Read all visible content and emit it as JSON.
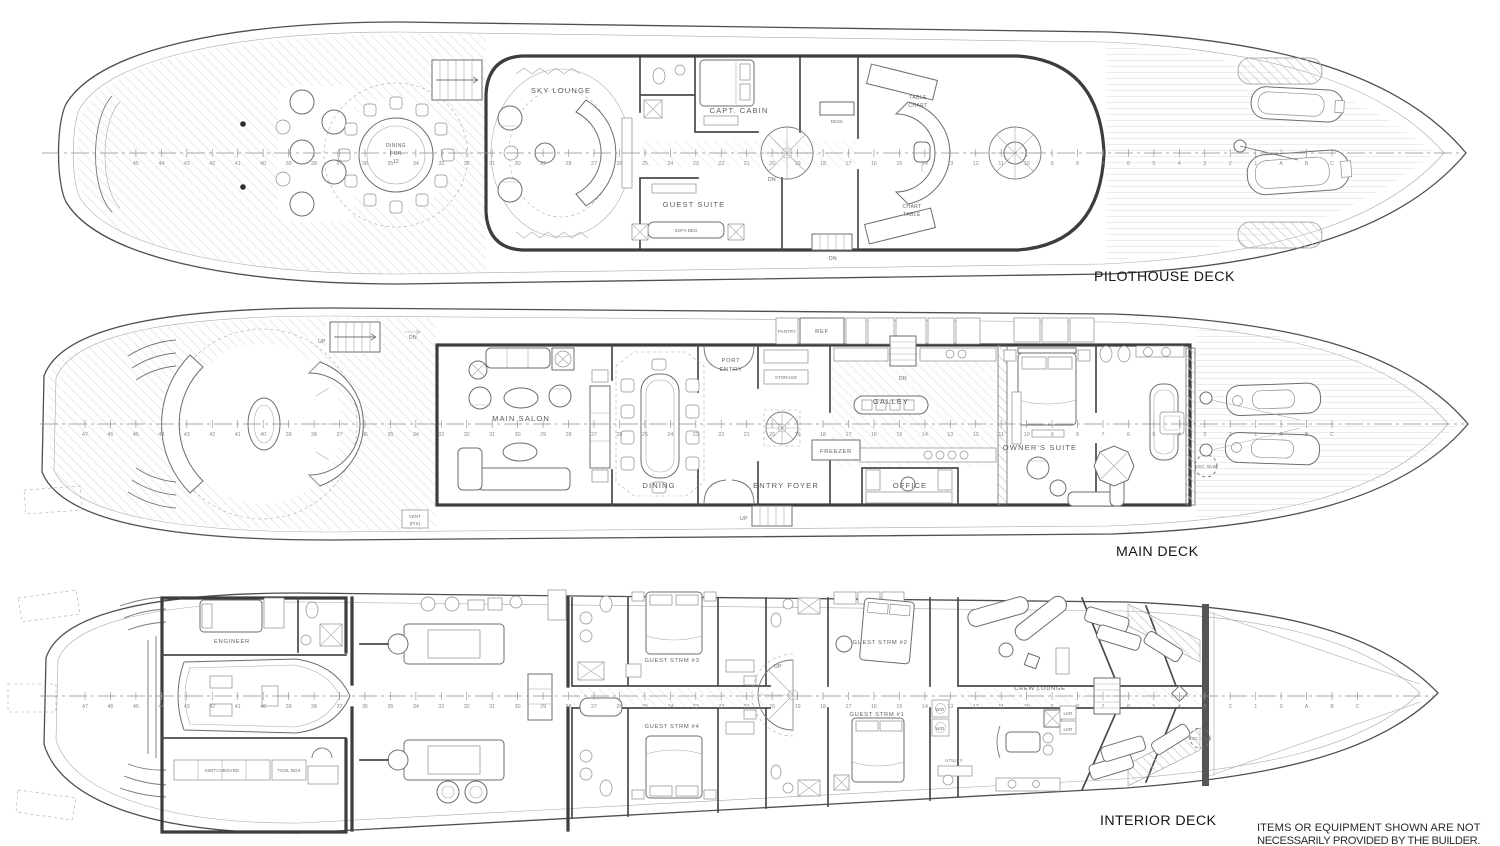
{
  "decks": {
    "pilothouse": {
      "label": "PILOTHOUSE DECK",
      "rooms": {
        "dining_1": "DINING",
        "dining_2": "FOR",
        "dining_3": "12",
        "sky_lounge": "SKY LOUNGE",
        "capt_cabin": "CAPT. CABIN",
        "guest_suite": "GUEST SUITE",
        "sofa_bed": "SOFA BED",
        "desk": "DESK",
        "table_chart_1": "TABLE",
        "table_chart_2": "CHART",
        "chart_table_1": "CHART",
        "chart_table_2": "TABLE"
      }
    },
    "main": {
      "label": "MAIN DECK",
      "rooms": {
        "main_salon": "MAIN SALON",
        "dining": "DINING",
        "port_entry_1": "PORT",
        "port_entry_2": "ENTRY",
        "entry_foyer": "ENTRY FOYER",
        "pantry": "PANTRY",
        "ref": "REF",
        "storage": "STORAGE",
        "galley": "GALLEY",
        "freezer": "FREEZER",
        "office": "OFFICE",
        "owners_suite": "OWNER'S SUITE",
        "vent_1": "VENT",
        "vent_2": "(P/S)",
        "esc": "ESC. BLW"
      }
    },
    "interior": {
      "label": "INTERIOR DECK",
      "rooms": {
        "engineer": "ENGINEER",
        "switchboard": "SWITCHBOARD",
        "tool_box": "TOOL BOX",
        "guest_3": "GUEST STRM #3",
        "guest_4": "GUEST STRM #4",
        "guest_2": "GUEST STRM #2",
        "guest_1": "GUEST STRM #1",
        "crew_lounge": "CREW LOUNGE",
        "utility": "UTILITY",
        "wd": "W/D",
        "lkr": "LKR",
        "esc": "ESC. OVR"
      }
    }
  },
  "common": {
    "up": "UP",
    "dn": "DN"
  },
  "frames": {
    "pilothouse": [
      "45",
      "44",
      "43",
      "42",
      "41",
      "40",
      "39",
      "38",
      "37",
      "36",
      "35",
      "34",
      "33",
      "32",
      "31",
      "30",
      "29",
      "28",
      "27",
      "26",
      "25",
      "24",
      "23",
      "22",
      "21",
      "20",
      "19",
      "18",
      "17",
      "16",
      "15",
      "14",
      "13",
      "12",
      "11",
      "10",
      "9",
      "8",
      "7",
      "6",
      "5",
      "4",
      "3",
      "2",
      "1",
      "A",
      "B",
      "C"
    ],
    "main": [
      "47",
      "46",
      "45",
      "44",
      "43",
      "42",
      "41",
      "40",
      "39",
      "38",
      "37",
      "36",
      "35",
      "34",
      "33",
      "32",
      "31",
      "30",
      "29",
      "28",
      "27",
      "26",
      "25",
      "24",
      "23",
      "22",
      "21",
      "20",
      "19",
      "18",
      "17",
      "16",
      "15",
      "14",
      "13",
      "12",
      "11",
      "10",
      "9",
      "8",
      "7",
      "6",
      "5",
      "4",
      "3",
      "2",
      "1",
      "A",
      "B",
      "C"
    ],
    "interior": [
      "47",
      "46",
      "45",
      "44",
      "43",
      "42",
      "41",
      "40",
      "39",
      "38",
      "37",
      "36",
      "35",
      "34",
      "33",
      "32",
      "31",
      "30",
      "29",
      "28",
      "27",
      "26",
      "25",
      "24",
      "23",
      "22",
      "21",
      "20",
      "19",
      "18",
      "17",
      "16",
      "15",
      "14",
      "13",
      "12",
      "11",
      "10",
      "9",
      "8",
      "7",
      "6",
      "5",
      "4",
      "3",
      "2",
      "1",
      "0",
      "A",
      "B",
      "C"
    ]
  },
  "notes": {
    "disclaimer_line1": "ITEMS OR EQUIPMENT SHOWN ARE NOT",
    "disclaimer_line2": "NECESSARILY PROVIDED BY THE BUILDER."
  },
  "colors": {
    "ink": "#3d3d3d",
    "thin_line": "#8d8d8d",
    "hatch": "#cdcdcd",
    "background": "#ffffff"
  }
}
